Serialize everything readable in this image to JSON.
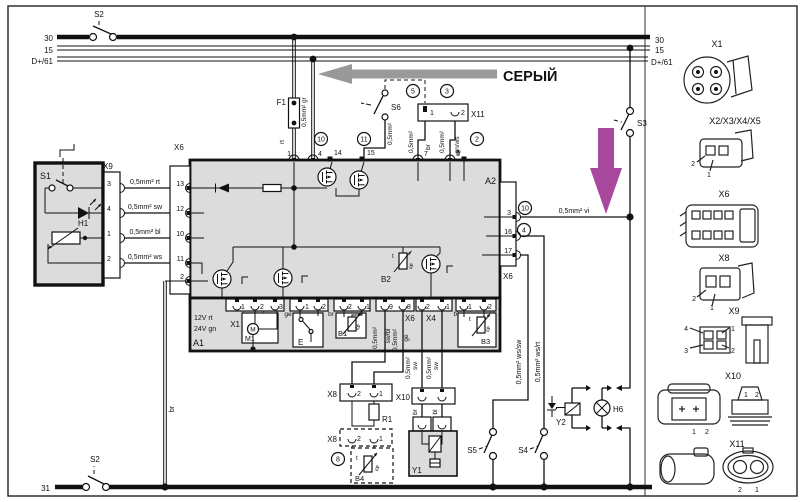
{
  "colors": {
    "purple": "#a8499e",
    "gray": "#999999",
    "panel": "#dcdcdc"
  },
  "buses": {
    "left_30": "30",
    "left_15": "15",
    "left_d61": "D+/61",
    "right_30": "30",
    "right_15": "15",
    "right_d61": "D+/61",
    "bottom_31": "31"
  },
  "switches": {
    "s2_top": "S2",
    "s2_bottom": "S2",
    "s3": "S3",
    "s4": "S4",
    "s5": "S5",
    "s6": "S6"
  },
  "annotations": {
    "gray_arrow_text": "СЕРЫЙ"
  },
  "components": {
    "s1": "S1",
    "h1": "H1",
    "f1": "F1",
    "a1": "A1",
    "a2": "A2",
    "m1": "M1",
    "m": "M",
    "e": "E",
    "b1": "B1",
    "b2": "B2",
    "b3": "B3",
    "b4": "B4",
    "r1": "R1",
    "y1": "Y1",
    "y2": "Y2",
    "h6": "H6",
    "supply_12": "12V rt",
    "supply_24": "24V gn",
    "theta": "ϑ",
    "t_mark": "t"
  },
  "connectors": {
    "x9": "X9",
    "x6_left": "X6",
    "x6_right": "X6",
    "x6_bottom": "X6",
    "x11": "X11",
    "x1": "X1",
    "x2": "X2",
    "x3": "X3",
    "x4": "X4",
    "x5": "X5",
    "x8": "X8",
    "x8_dashed": "X8",
    "x10": "X10"
  },
  "pins": {
    "x9": [
      "3",
      "4",
      "1",
      "2"
    ],
    "x6_left": [
      "13",
      "12",
      "10",
      "11",
      "2"
    ],
    "a2_top": [
      "1",
      "4",
      "14",
      "15",
      "7",
      "5",
      "6"
    ],
    "x6_right": [
      "3",
      "16",
      "17"
    ],
    "x11": [
      "1",
      "2"
    ],
    "x1": [
      "1",
      "2",
      "3"
    ],
    "x2": [
      "1",
      "2"
    ],
    "x5": [
      "2",
      "1"
    ],
    "x6_bottom": [
      "9",
      "8"
    ],
    "x4": [
      "2",
      "1"
    ],
    "x3": [
      "1",
      "2"
    ],
    "x8": [
      "2",
      "1"
    ],
    "x8_dashed": [
      "2",
      "1"
    ]
  },
  "circled": {
    "top_10": "10",
    "top_11": "11",
    "top_2": "2",
    "top_5": "5",
    "top_3": "3",
    "right_10": "10",
    "right_4": "4",
    "bottom_8": "8"
  },
  "wires": {
    "gr": "0,5mm² gr",
    "rt": "rt",
    "x9_rt": "0,5mm² rt",
    "x9_sw": "0,5mm² sw",
    "x9_bl": "0,5mm² bl",
    "x9_ws": "0,5mm² ws",
    "s6": "0,5mm²",
    "x11_1_gauge": "0,5mm²",
    "x11_1_color": "br",
    "x11_2_gauge": "0,5mm²",
    "x11_2_color": "gn/ws",
    "vi": "0,5mm² vi",
    "ws_sw": "0,5mm² ws/sw",
    "ws_rt": "0,5mm² ws/rt",
    "pin9_gauge": "0,5mm²",
    "pin9_color": "sw/bl",
    "pin8_gauge": "0,5mm²",
    "pin8_color": "ge",
    "x4_2_gauge": "0,5mm²",
    "x4_2_color": "sw",
    "x4_1_gauge": "0,5mm²",
    "x4_1_color": "sw",
    "gnd_br": "br",
    "y1_br": "br",
    "y1_bl": "bl",
    "x1_br_a": "br",
    "x1_br_b": "br",
    "x2_ge_a": "ge",
    "x2_ge_b": "ge",
    "x5_br_a": "br",
    "x5_br_b": "br",
    "x3_bl_a": "bl",
    "x3_bl_b": "bl"
  },
  "gallery": {
    "x1": "X1",
    "x2345": "X2/X3/X4/X5",
    "x6": "X6",
    "x8": "X8",
    "x9": "X9",
    "x10": "X10",
    "x11": "X11",
    "x2345_pins": [
      "2",
      "1"
    ],
    "x8_pins": [
      "2",
      "1"
    ],
    "x9_pins": [
      "4",
      "1",
      "3",
      "2"
    ],
    "x10_left_pins": [
      "1",
      "2"
    ],
    "x10_right_pins": [
      "1",
      "2"
    ],
    "x11_pins": [
      "2",
      "1"
    ]
  }
}
